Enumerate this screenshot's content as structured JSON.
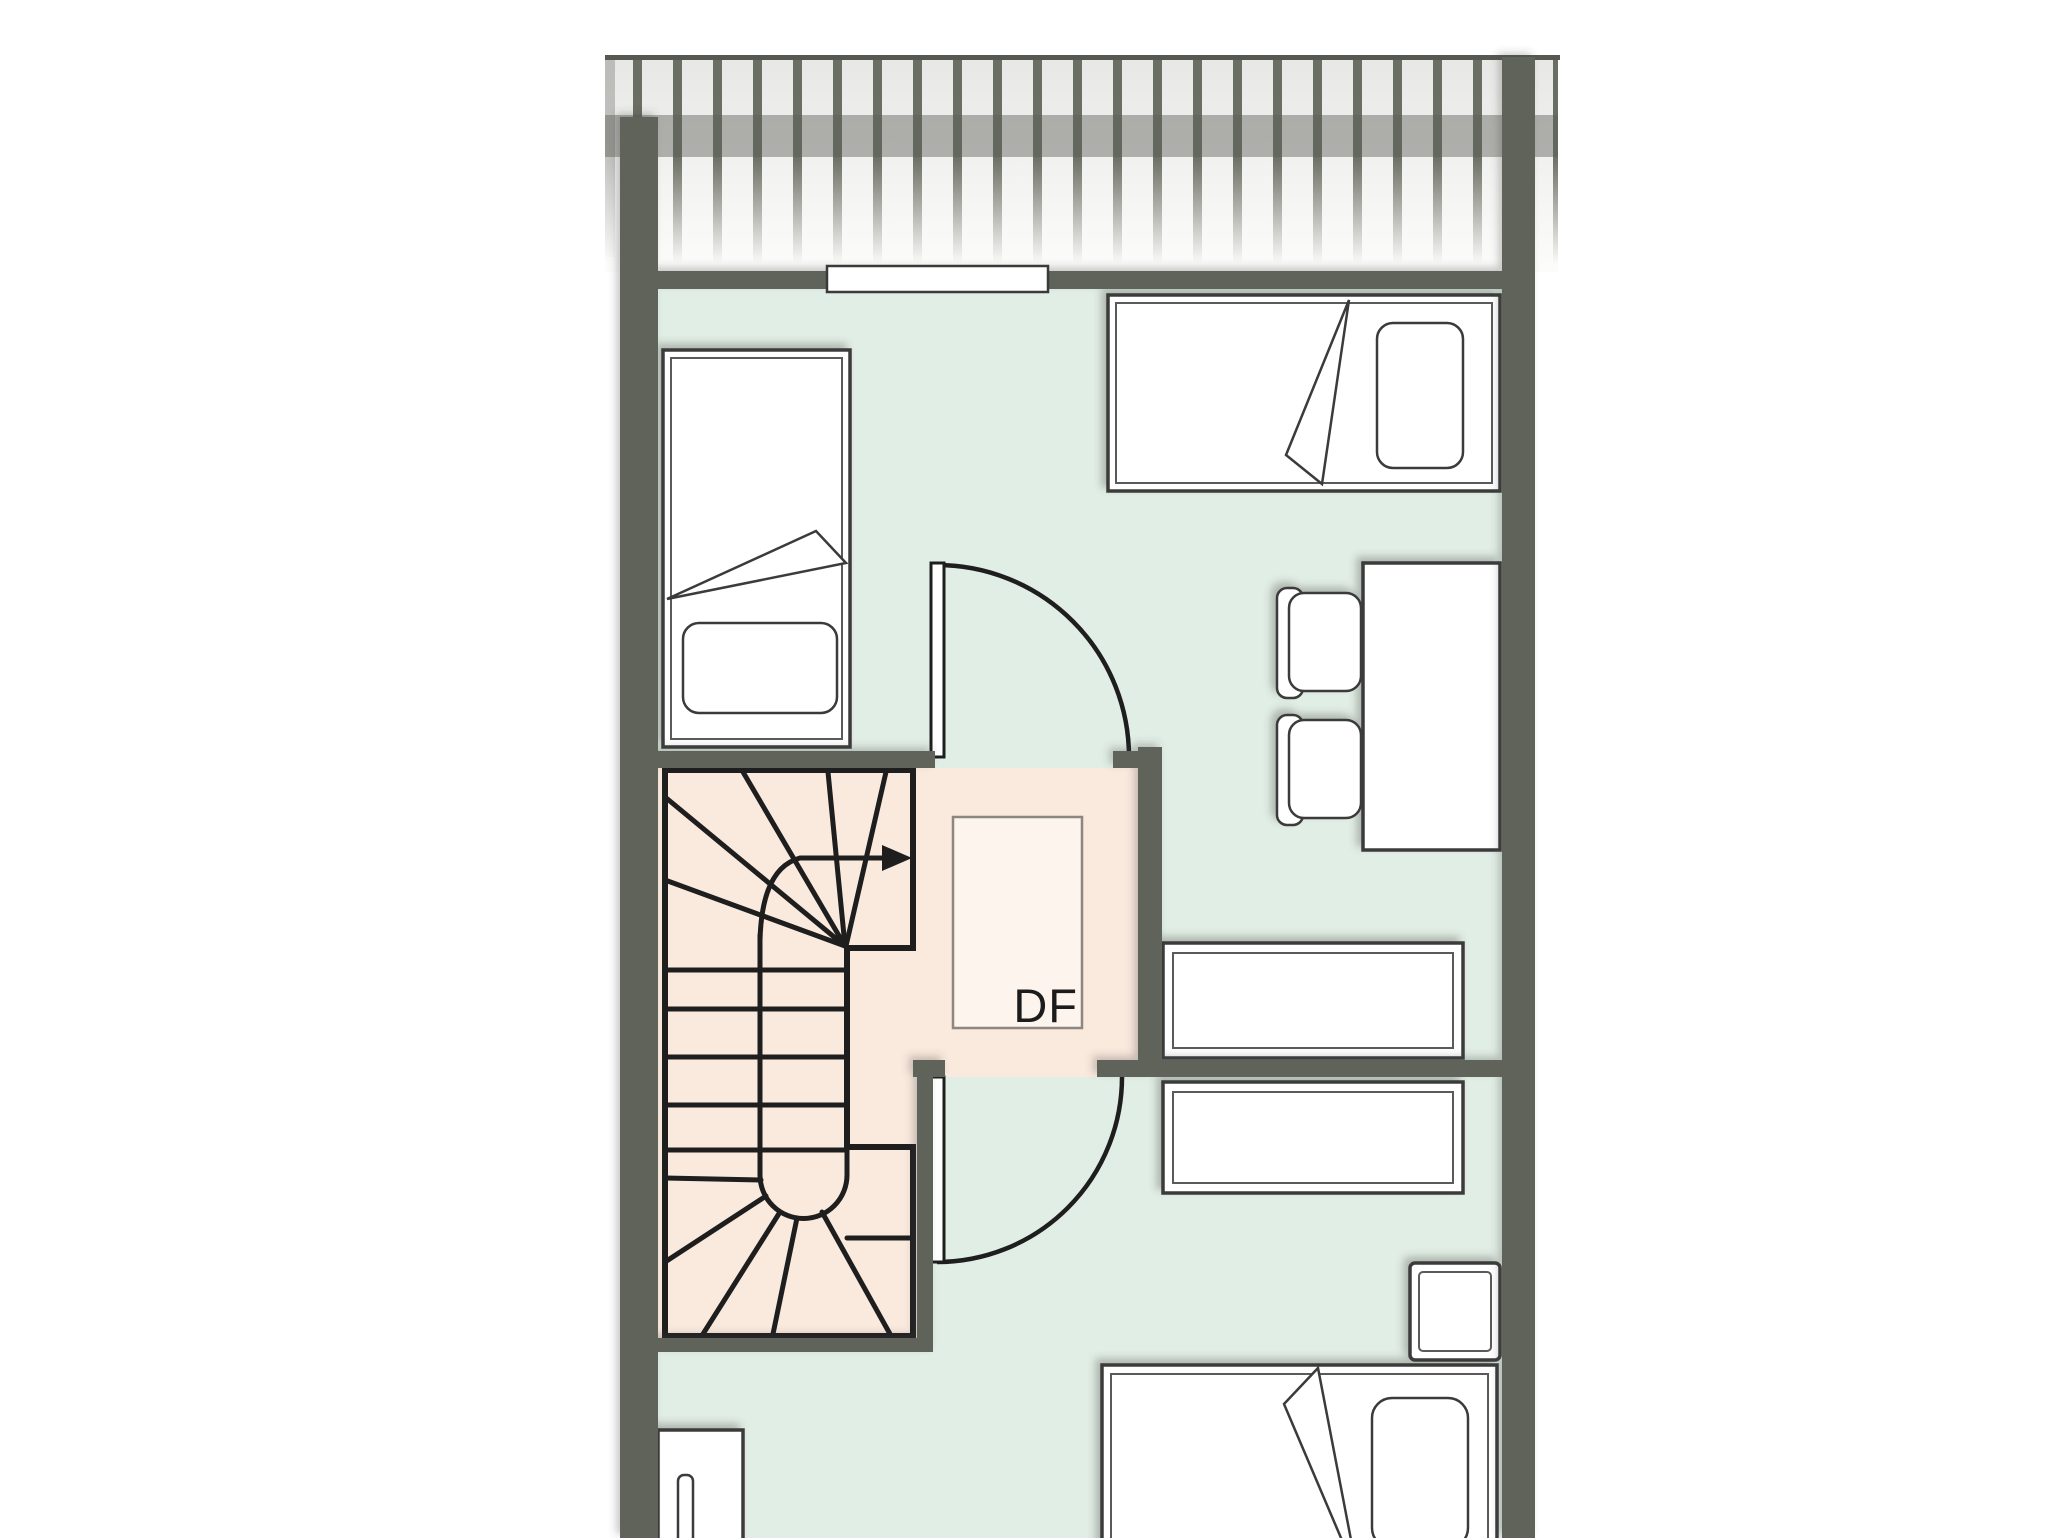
{
  "title": "attic-floor-plan",
  "skylight": {
    "label": "DF"
  },
  "colors": {
    "background": "#ffffff",
    "wall": "#61645a",
    "floor-green": "#e1eee5",
    "floor-pink": "#fae9dd",
    "skylight-fill": "#fdf4ee",
    "skylight-border": "#8c8780",
    "line-black": "#1e1e1e",
    "furniture-stroke": "#3a3a3a",
    "furniture-inner": "#5a5a5a",
    "furniture-fill": "#ffffff",
    "roof-stripe": "#6b6e63",
    "roof-band": "#5d6056",
    "roof-bg-top": "#e7e7e6",
    "roof-bg-bottom": "#fcfcfb",
    "roof-topline": "#565952"
  },
  "plan": {
    "roof": {
      "type": "striped-roof-overhang",
      "position": "top"
    },
    "rooms": {
      "top_room": {
        "floor": "green",
        "furniture": [
          "single-bed-vertical",
          "single-bed-horizontal",
          "desk",
          "chair-upper",
          "chair-lower",
          "dresser-upper"
        ],
        "openings": [
          "window-top-wall",
          "door-to-landing"
        ]
      },
      "stair_landing": {
        "floor": "pink",
        "features": [
          "winder-staircase",
          "up-arrow",
          "skylight-DF"
        ],
        "openings": [
          "door-to-top-room",
          "door-to-bottom-room"
        ]
      },
      "bottom_room": {
        "floor": "green",
        "furniture": [
          "dresser-lower",
          "nightstand",
          "double-bed",
          "radiator"
        ],
        "openings": [
          "door-to-landing"
        ]
      }
    }
  }
}
